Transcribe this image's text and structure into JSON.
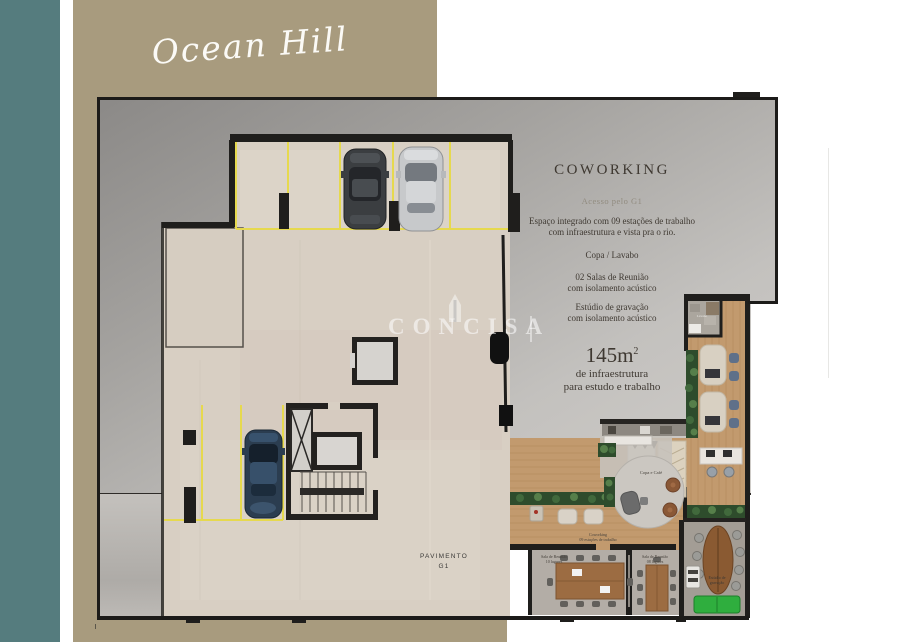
{
  "brand": {
    "script_title": "Ocean Hill"
  },
  "watermark": {
    "text": "CONCISA"
  },
  "info_panel": {
    "title": "COWORKING",
    "subtitle": "Acesso pelo G1",
    "features": [
      {
        "l1": "Espaço integrado com 09 estações de trabalho",
        "l2": "com infraestrutura e vista pra o rio."
      },
      {
        "l1": "Copa / Lavabo",
        "l2": ""
      },
      {
        "l1": "02 Salas de Reunião",
        "l2": "com isolamento acústico"
      },
      {
        "l1": "Estúdio de gravação",
        "l2": "com isolamento acústico"
      }
    ],
    "area_value": "145m",
    "area_exponent": "2",
    "area_l1": "de infraestrutura",
    "area_l2": "para estudo e trabalho"
  },
  "floor_plan": {
    "floor_label_l1": "PAVIMENTO",
    "floor_label_l2": "G1",
    "room_labels": {
      "copa_cafe": "Copa e Café",
      "lavabo": "Lavabo",
      "coworking_l1": "Coworking",
      "coworking_l2": "09 estações de trabalho",
      "meeting1_l1": "Sala de Reunião",
      "meeting1_l2": "10 lugares",
      "meeting2_l1": "Sala de Reunião",
      "meeting2_l2": "08 lugares",
      "studio_l1": "Estúdio de",
      "studio_l2": "gravação"
    }
  },
  "colors": {
    "sidebar_teal": "#557c7e",
    "backdrop_tan": "#a89b7e",
    "panel_gray": "#b3b1ae",
    "floor_beige": "#d8cfc3",
    "parking_yellow": "#e6d94e",
    "wood": "#c29a6e",
    "plant_green": "#2e4c2c",
    "sofa_green": "#2fae3e",
    "wall_dark": "#1f1e1c",
    "text_dark": "#3e3831"
  }
}
